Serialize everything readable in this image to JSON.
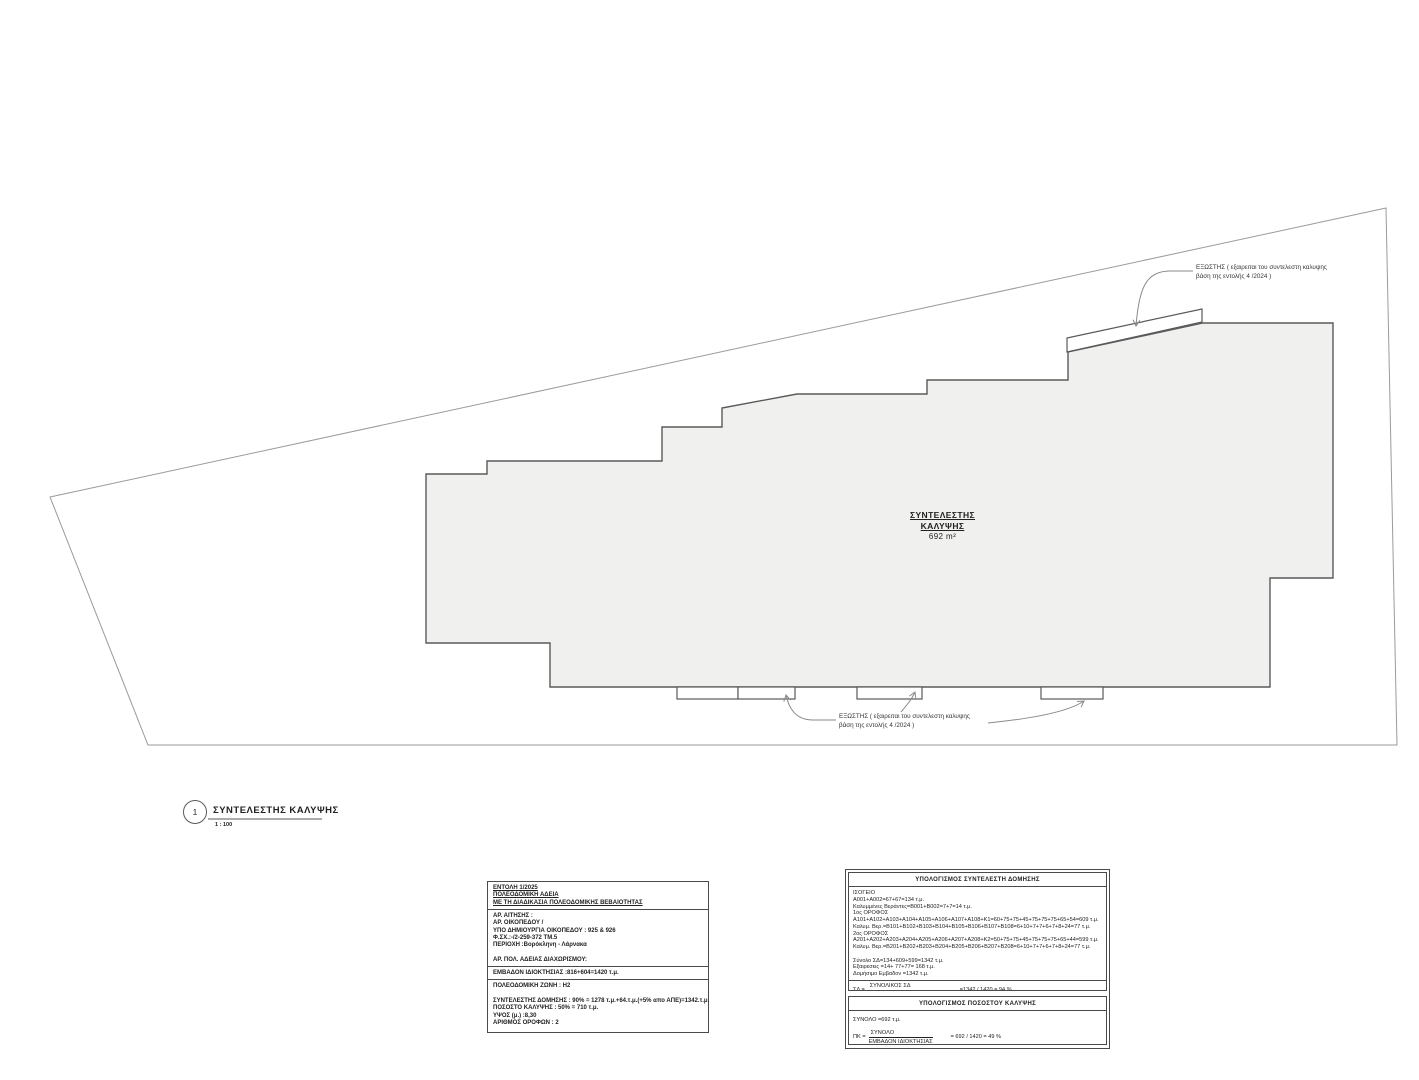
{
  "colors": {
    "background": "#ffffff",
    "line_dark": "#4a4a4a",
    "line_light": "#9a9a9a",
    "building_fill": "#f0f0ef",
    "text": "#1a1a1a"
  },
  "plan": {
    "coverage_label": {
      "title_line1": "ΣΥΝΤΕΛΕΣΤΗΣ",
      "title_line2": "ΚΑΛΥΨΗΣ",
      "area": "692 m²"
    },
    "balcony_note_top": {
      "line1": "ΕΞΩΣΤΗΣ ( εξαιρειται του συντελεστη καλυψης",
      "line2": "βάση της εντολής 4 /2024 )"
    },
    "balcony_note_bottom": {
      "line1": "ΕΞΩΣΤΗΣ ( εξαιρειται του συντελεστη καλυψης",
      "line2": "βάση της εντολής 4 /2024 )"
    }
  },
  "title_block": {
    "detail_number": "1",
    "title": "ΣΥΝΤΕΛΕΣΤΗΣ ΚΑΛΥΨΗΣ",
    "scale": "1 : 100"
  },
  "permit_box": {
    "header_lines": [
      "ΕΝΤΟΛΗ 1/2025",
      "ΠΟΛΕΟΔΟΜΙΚΗ ΑΔΕΙΑ",
      "ΜΕ ΤΗ ΔΙΑΔΙΚΑΣΙΑ ΠΟΛΕΟΔΟΜΙΚΗΣ ΒΕΒΑΙΟΤΗΤΑΣ"
    ],
    "application_lines": [
      "ΑΡ. ΑΙΤΗΣΗΣ :",
      "ΑΡ. ΟΙΚΟΠΕΔΟΥ /",
      "ΥΠΟ ΔΗΜΙΟΥΡΓΙΑ ΟΙΚΟΠΕΔΟΥ : 925 & 926",
      "Φ.ΣΧ.:-/2-259-372 ΤΜ.5",
      "ΠΕΡΙΟΧΗ :Βορόκληνη - Λάρνακα",
      "",
      "ΑΡ. ΠΟΛ. ΑΔΕΙΑΣ ΔΙΑΧΩΡΙΣΜΟΥ:"
    ],
    "property_area_line": "ΕΜΒΑΔΟΝ ΙΔΙΟΚΤΗΣΙΑΣ :816+604=1420 τ.μ.",
    "zone_lines": [
      "ΠΟΛΕΟΔΟΜΙΚΗ ΖΩΝΗ  :  Η2",
      "",
      "ΣΥΝΤΕΛΕΣΤΗΣ ΔΟΜΗΣΗΣ : 90% = 1278 τ.μ.+64.τ.μ.(+5% απο ΑΠΕ)=1342.τ.μ.",
      "ΠΟΣΟΣΤΟ ΚΑΛΥΨΗΣ : 50% = 710 τ.μ.",
      "ΥΨΟΣ (μ.) :8,30",
      "ΑΡΙΘΜΟΣ ΟΡΟΦΩΝ : 2"
    ]
  },
  "building_calc_box": {
    "title": "ΥΠΟΛΟΓΙΣΜΟΣ ΣΥΝΤΕΛΕΣΤΗ ΔΟΜΗΣΗΣ",
    "lines": [
      "ΙΣΟΓΕΙΟ",
      "Α001+Α002=67+67=134 τ.μ.",
      "Καλυμμένες Βεράντες=Β001+Β002=7+7=14 τ.μ.",
      "1ος ΟΡΟΦΟΣ",
      "Α101+Α102+Α103+Α104+Α105+Α106+Α107+Α108+Κ1=60+75+75+45+75+75+75+65+54=609  τ.μ.",
      "Καλυμ. Βερ.=Β101+Β102+Β103+Β104+Β105+Β106+Β107+Β108=6+10+7+7+6+7+8+24=77 τ.μ.",
      "2ος ΟΡΟΦΟΣ",
      "Α201+Α202+Α203+Α204+Α205+Α206+Α207+Α208+Κ2=50+75+75+45+75+75+75+65+44=599 τ.μ.",
      "Καλυμ. Βερ.=Β201+Β202+Β203+Β204+Β205+Β206+Β207+Β208=6+10+7+7+6+7+8+24=77 τ.μ.",
      "",
      "Σύνολο ΣΔ=134+609+599=1342 τ.μ.",
      "Εξαιρεσεις =14+ 77+77= 168 τ.μ.",
      "Δομήσιμο Εμβαδον =1342 τ.μ."
    ],
    "formula": {
      "lhs": "ΣΔ =",
      "numerator": "ΣΥΝΟΛΙΚΟΣ ΣΔ",
      "denominator": "ΕΜΒΑΔΟΝ ΙΔΙΟΚΤΗΣΙΑΣ",
      "result": "=1342 / 1420 = 94 %"
    }
  },
  "coverage_calc_box": {
    "title": "ΥΠΟΛΟΓΙΣΜΟΣ ΠΟΣΟΣΤΟΥ ΚΑΛΥΨΗΣ",
    "total_line": "ΣΥΝΟΛΟ =692 τ.μ.",
    "formula": {
      "lhs": "ΠΚ =",
      "numerator": "ΣΥΝΟΛΟ",
      "denominator": "ΕΜΒΑΔΟΝ ΙΔΙΟΚΤΗΣΙΑΣ",
      "result": "= 692 / 1420 = 49 %"
    }
  }
}
